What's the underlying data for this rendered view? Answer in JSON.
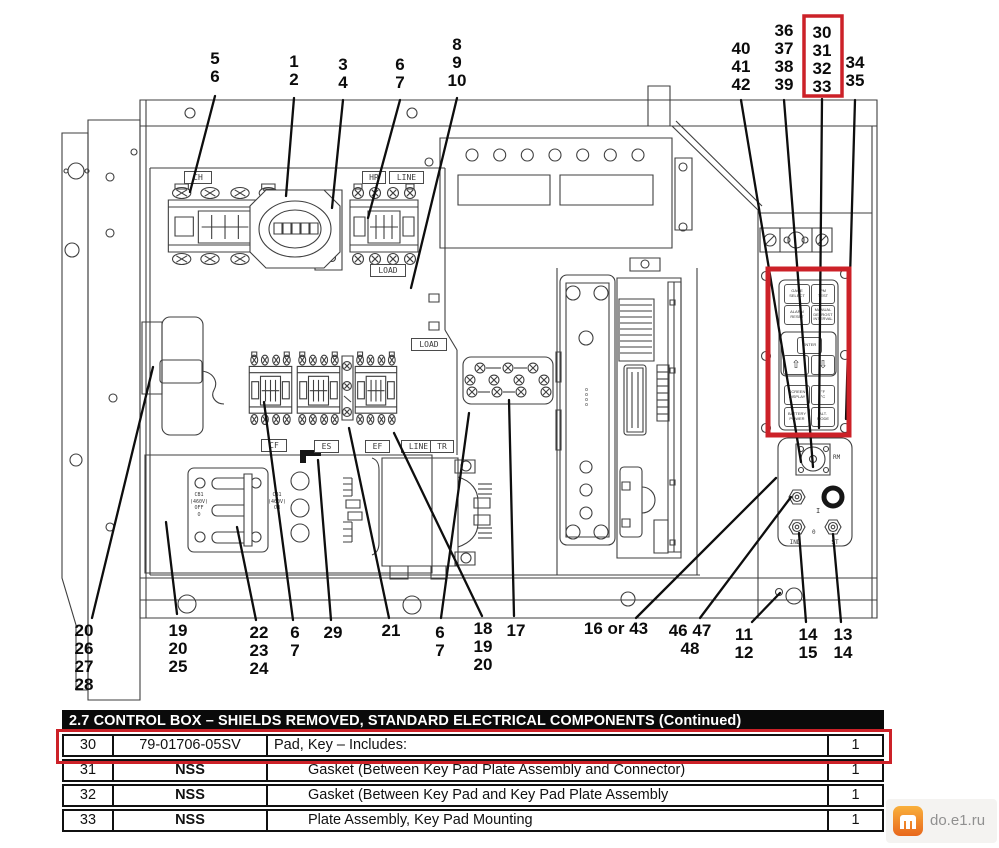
{
  "colors": {
    "highlight_red": "#cc2128",
    "line": "#3f3f3f",
    "ink": "#0e0e0e",
    "table_header_bg": "#0a0a0a",
    "watermark_orange": "#ef8b2d",
    "watermark_text": "#909090"
  },
  "callouts": {
    "t1": "5\n6",
    "t2": "1\n2",
    "t3": "3\n4",
    "t4": "6\n7",
    "t5": "8\n9\n10",
    "t6": "40\n41\n42",
    "t7": "36\n37\n38\n39",
    "t8": "30\n31\n32\n33",
    "t9": "34\n35",
    "b1": "20\n26\n27\n28",
    "b2": "19\n20\n25",
    "b3": "22\n23\n24",
    "b4": "6\n7",
    "b5": "29",
    "b6": "21",
    "b7": "6\n7",
    "b8": "18\n19\n20",
    "b9": "17",
    "b10": "16 or 43",
    "b11": "46 47\n48",
    "b12": "11\n12",
    "b13": "14\n15",
    "b14": "13\n14"
  },
  "labels": {
    "ch": "CH",
    "hr": "HR",
    "line_top": "LINE",
    "load_top": "LOAD",
    "load_mid": "LOAD",
    "cf": "CF",
    "es": "ES",
    "ef": "EF",
    "line_mid": "LINE",
    "tr": "TR",
    "cb1_left": "CB1\n(460V)\nOFF\nO",
    "cb1_right": "CB1\n(460V)\nON",
    "rm": "RM",
    "ind": "IND",
    "st": "ST",
    "switch_on": "I",
    "switch_off": "0",
    "board_marks": "oooo"
  },
  "keypad": {
    "r1l": "GAGE\nSELECT",
    "r1r": "PM\nTEST",
    "r2l": "ALARM\nRESET",
    "r2r": "MANUAL\nDEFROST\nINTERVAL",
    "enter": "ENTER",
    "up": "⇧",
    "down": "⇩",
    "r3l": "SCREEN\nDISPLAY",
    "r3r": "°F\n°C",
    "r4l": "BATTERY\nPOWER",
    "r4r": "ALT.\nMODE"
  },
  "table": {
    "title": "2.7 CONTROL BOX – SHIELDS REMOVED, STANDARD ELECTRICAL COMPONENTS (Continued)",
    "rows": [
      {
        "item": "30",
        "part": "79-01706-05SV",
        "desc": "Pad, Key – Includes:",
        "qty": "1"
      },
      {
        "item": "31",
        "part": "NSS",
        "desc": "Gasket (Between Key Pad Plate Assembly and Connector)",
        "qty": "1"
      },
      {
        "item": "32",
        "part": "NSS",
        "desc": "Gasket (Between Key Pad  and Key Pad Plate Assembly",
        "qty": "1"
      },
      {
        "item": "33",
        "part": "NSS",
        "desc": "Plate Assembly, Key Pad Mounting",
        "qty": "1"
      }
    ]
  },
  "watermark": {
    "text": "do.e1.ru"
  }
}
